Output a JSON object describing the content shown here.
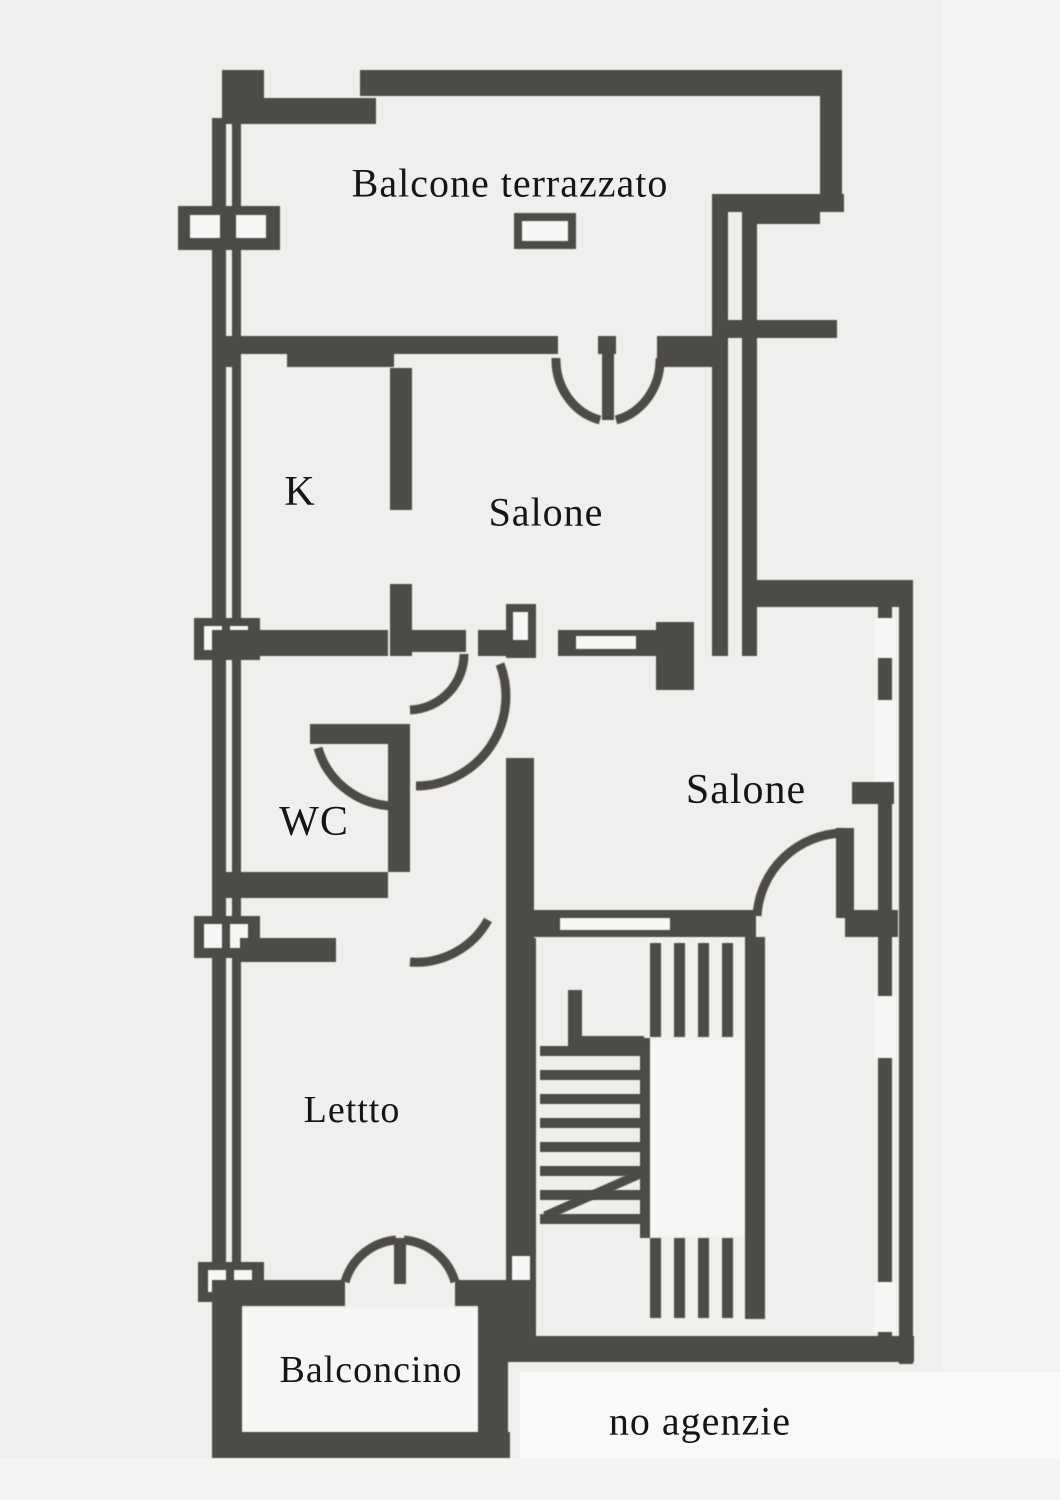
{
  "rooms": {
    "balcone_terrazzato": {
      "label": "Balcone terrazzato"
    },
    "kitchen": {
      "label": "K"
    },
    "salone_upper": {
      "label": "Salone"
    },
    "wc": {
      "label": "WC"
    },
    "salone_lower": {
      "label": "Salone"
    },
    "letto": {
      "label": "Lettto"
    },
    "balconcino": {
      "label": "Balconcino"
    }
  },
  "annotations": {
    "note": "no agenzie"
  },
  "colors": {
    "background": "#f1efed",
    "wall": "#4d4b48",
    "paper_white": "#f7f6f4",
    "text": "#151515"
  }
}
